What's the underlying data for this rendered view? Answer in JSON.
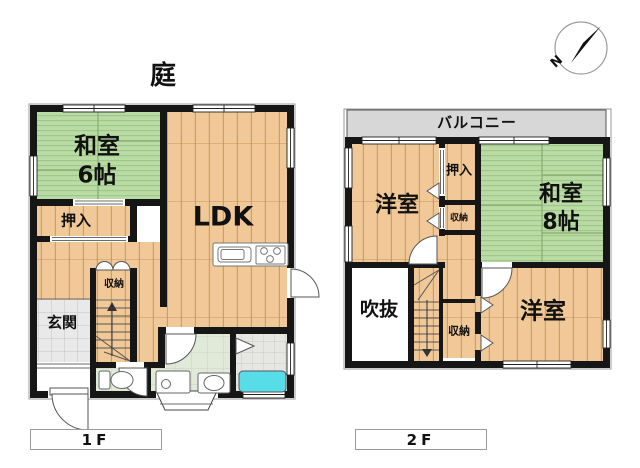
{
  "garden_label": "庭",
  "compass": {
    "letter": "N"
  },
  "floor1": {
    "label": "1F",
    "rooms": {
      "washitsu_name": "和室",
      "washitsu_size": "6帖",
      "oshiire": "押入",
      "ldk": "LDK",
      "shuno": "収納",
      "genkan": "玄関"
    }
  },
  "floor2": {
    "label": "2F",
    "balcony": "バルコニー",
    "rooms": {
      "yoshitsu_upper": "洋室",
      "oshiire": "押入",
      "shuno_upper": "収納",
      "washitsu_name": "和室",
      "washitsu_size": "8帖",
      "fukinuke": "吹抜",
      "shuno_lower": "収納",
      "yoshitsu_lower": "洋室"
    }
  },
  "colors": {
    "wall": "#161616",
    "tatami": "#b9dca4",
    "tatami_seam": "#85ab71",
    "wood": "#f1c897",
    "wood_grain": "#d9a96e",
    "entry_tile": "#e9e9e9",
    "washroom_floor": "#e1e9d9",
    "bath_tile": "#e6e6e2",
    "bathtub": "#57dde8",
    "balcony": "#d7d7d7"
  }
}
